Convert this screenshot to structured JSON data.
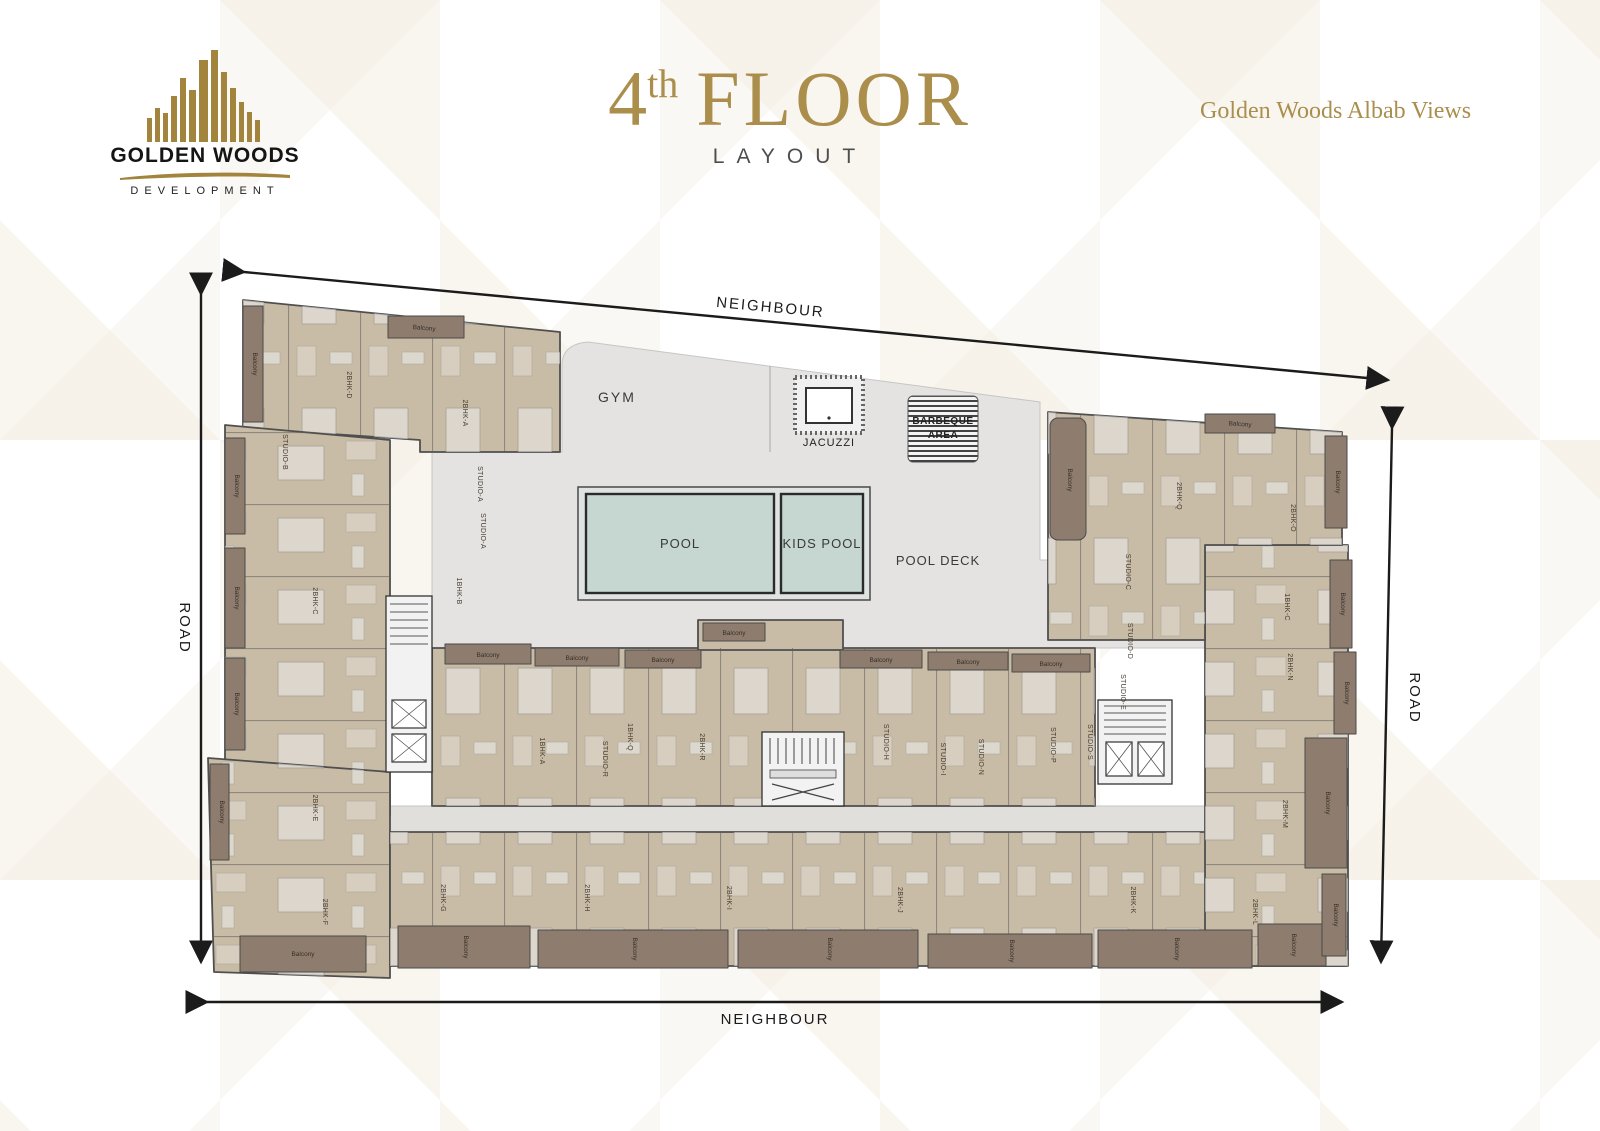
{
  "header": {
    "logo": {
      "company": "GOLDEN WOODS",
      "division": "DEVELOPMENT"
    },
    "title": {
      "floor_number": "4",
      "ordinal_suffix": "th",
      "floor_word": "FLOOR",
      "subtitle": "LAYOUT"
    },
    "project_name": "Golden Woods Albab Views"
  },
  "plan": {
    "amenities": {
      "gym": "GYM",
      "jacuzzi": "JACUZZI",
      "barbeque_line1": "BARBEQUE",
      "barbeque_line2": "AREA",
      "pool": "POOL",
      "kids_pool": "KIDS POOL",
      "pool_deck": "POOL DECK"
    },
    "surroundings": {
      "neighbour_top": "NEIGHBOUR",
      "neighbour_bottom": "NEIGHBOUR",
      "road_left": "ROAD",
      "road_right": "ROAD"
    },
    "balcony_label": "Balcony",
    "units": [
      "2BHK-D",
      "2BHK-A",
      "STUDIO-B",
      "STUDIO-A",
      "STUDIO-A",
      "1BHK-B",
      "2BHK-C",
      "2BHK-E",
      "2BHK-F",
      "2BHK-G",
      "2BHK-H",
      "2BHK-I",
      "2BHK-J",
      "2BHK-K",
      "2BHK-L",
      "2BHK-M",
      "2BHK-N",
      "1BHK-C",
      "2BHK-O",
      "2BHK-Q",
      "STUDIO-C",
      "STUDIO-D",
      "STUDIO-E",
      "1BHK-A",
      "STUDIO-R",
      "1BHK-Q",
      "2BHK-R",
      "STUDIO-H",
      "STUDIO-I",
      "STUDIO-N",
      "STUDIO-P",
      "STUDIO-S"
    ]
  },
  "colors": {
    "gold": "#ab8d4c",
    "unit_fill": "#c9bca6",
    "balcony_fill": "#8e7d6e",
    "deck_fill": "#e4e3e1",
    "pool_fill": "#c6d6d1",
    "wall": "#4f4f4f",
    "arrow": "#1b1b1b"
  }
}
